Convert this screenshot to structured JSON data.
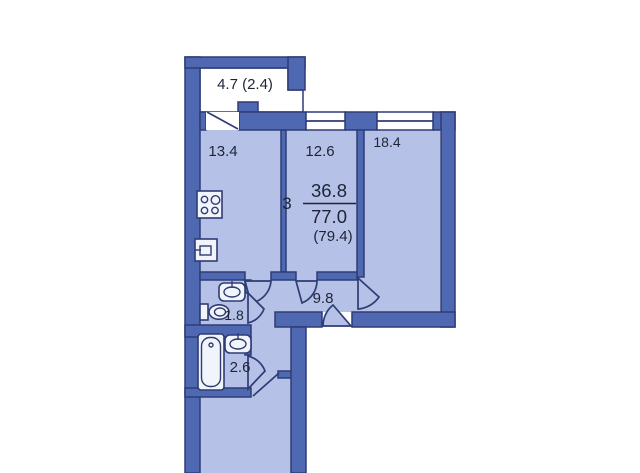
{
  "plan": {
    "title": "apartment-floorplan",
    "summary": {
      "rooms_count": "3",
      "living_area": "36.8",
      "total_area": "77.0",
      "area_with_balcony": "(79.4)"
    },
    "areas": {
      "balcony": "4.7 (2.4)",
      "kitchen": "13.4",
      "room_a": "12.6",
      "room_b": "18.4",
      "wc": "1.8",
      "bathroom": "2.6",
      "hallway": "9.8"
    },
    "colors": {
      "wall": "#4f68b2",
      "room_fill": "#b5c1e7",
      "outline": "#2e3c74",
      "text": "#1e2436",
      "background": "#ffffff",
      "fixture_fill": "#f2f4fb"
    },
    "fixtures": [
      "stove",
      "kitchen-sink",
      "wc-sink",
      "toilet",
      "bathtub",
      "bathroom-sink"
    ]
  }
}
